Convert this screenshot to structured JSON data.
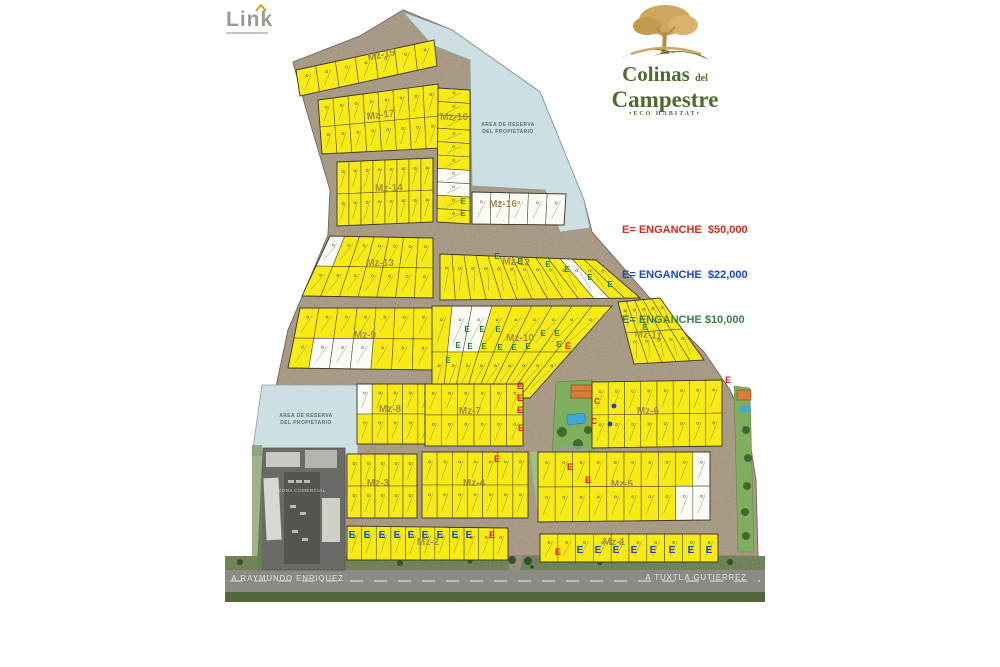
{
  "branding": {
    "link_logo": {
      "text": "Link"
    },
    "project_logo": {
      "line1": "Colinas",
      "line1_suffix": "del",
      "line2": "Campestre",
      "tagline": "•ECO HABITAT•"
    }
  },
  "legend": {
    "items": [
      {
        "label": "E= ENGANCHE  $50,000",
        "color": "#d42a1c"
      },
      {
        "label": "E= ENGANCHE  $22,000",
        "color": "#1c45c8"
      },
      {
        "label": "E= ENGANCHE $10,000",
        "color": "#3d7a4a"
      }
    ]
  },
  "roads": {
    "left_label": "A RAYMUNDO ENRIQUEZ",
    "right_label": "A TUXTLA GUTIERREZ"
  },
  "map": {
    "reserve_label": [
      "AREA DE RESERVA",
      "DEL PROPIETARIO"
    ],
    "commercial_label": "ZONA COMERCIAL",
    "colors": {
      "lot_yellow": "#f7ea15",
      "lot_white": "#fcfcf6",
      "road": "#a39178",
      "reserve": "#ccdfe2",
      "grass": "#5d7340",
      "mark_green": "#1e7e1e",
      "mark_red": "#e01818",
      "mark_blue": "#1742d8"
    },
    "outline": [
      [
        403,
        10
      ],
      [
        452,
        30
      ],
      [
        540,
        92
      ],
      [
        584,
        200
      ],
      [
        592,
        232
      ],
      [
        648,
        296
      ],
      [
        704,
        352
      ],
      [
        730,
        390
      ],
      [
        748,
        430
      ],
      [
        756,
        480
      ],
      [
        758,
        556
      ],
      [
        258,
        556
      ],
      [
        262,
        470
      ],
      [
        268,
        430
      ],
      [
        277,
        382
      ],
      [
        288,
        330
      ],
      [
        305,
        290
      ],
      [
        328,
        235
      ],
      [
        330,
        190
      ],
      [
        302,
        95
      ],
      [
        293,
        62
      ],
      [
        360,
        36
      ]
    ],
    "reserves": [
      {
        "poly": [
          [
            403,
            12
          ],
          [
            452,
            30
          ],
          [
            540,
            92
          ],
          [
            584,
            200
          ],
          [
            590,
            228
          ],
          [
            560,
            232
          ],
          [
            545,
            190
          ],
          [
            472,
            186
          ],
          [
            470,
            60
          ],
          [
            432,
            45
          ]
        ],
        "label_pos": [
          508,
          126
        ]
      },
      {
        "poly": [
          [
            262,
            385
          ],
          [
            358,
            385
          ],
          [
            358,
            455
          ],
          [
            252,
            455
          ]
        ],
        "label_pos": [
          306,
          417
        ]
      }
    ],
    "medians": [
      [
        [
          604,
          310
        ],
        [
          611,
          310
        ],
        [
          521,
          395
        ],
        [
          514,
          395
        ]
      ],
      [
        [
          530,
          452
        ],
        [
          537,
          452
        ],
        [
          545,
          518
        ],
        [
          538,
          518
        ]
      ]
    ],
    "blocks": [
      {
        "name": "Mz-15",
        "poly": [
          [
            296,
            70
          ],
          [
            434,
            40
          ],
          [
            437,
            66
          ],
          [
            300,
            96
          ]
        ],
        "rows": 1,
        "cols": 7,
        "white": [],
        "label": [
          382,
          58
        ],
        "la": -12
      },
      {
        "name": "Mz-17",
        "poly": [
          [
            318,
            100
          ],
          [
            438,
            84
          ],
          [
            441,
            148
          ],
          [
            322,
            154
          ]
        ],
        "rows": 2,
        "cols": 8,
        "white": [],
        "label": [
          381,
          118
        ],
        "la": -8
      },
      {
        "name": "Mz-16",
        "poly": [
          [
            438,
            88
          ],
          [
            470,
            90
          ],
          [
            470,
            224
          ],
          [
            437,
            222
          ]
        ],
        "rows": 10,
        "cols": 1,
        "white": [
          6,
          7
        ],
        "label": [
          454,
          120
        ],
        "la": 0
      },
      {
        "name": "Mz-16",
        "poly": [
          [
            472,
            192
          ],
          [
            566,
            194
          ],
          [
            564,
            225
          ],
          [
            472,
            224
          ]
        ],
        "rows": 1,
        "cols": 5,
        "white": [
          0,
          1,
          2,
          3,
          4
        ],
        "label": [
          503,
          207
        ],
        "la": 0
      },
      {
        "name": "Mz-14",
        "poly": [
          [
            337,
            162
          ],
          [
            433,
            158
          ],
          [
            433,
            222
          ],
          [
            337,
            226
          ]
        ],
        "rows": 2,
        "cols": 8,
        "white": [],
        "label": [
          389,
          191
        ],
        "la": -2
      },
      {
        "name": "Mz-13",
        "poly": [
          [
            330,
            236
          ],
          [
            433,
            238
          ],
          [
            433,
            298
          ],
          [
            302,
            296
          ]
        ],
        "rows": 2,
        "cols": 7,
        "white": [
          0
        ],
        "label": [
          380,
          266
        ],
        "la": 0
      },
      {
        "name": "Mz-12",
        "poly": [
          [
            440,
            254
          ],
          [
            596,
            260
          ],
          [
            640,
            298
          ],
          [
            440,
            300
          ]
        ],
        "rows": 1,
        "cols": 13,
        "white": [
          10
        ],
        "label": [
          516,
          265
        ],
        "la": 3
      },
      {
        "name": "Mz-9",
        "poly": [
          [
            300,
            308
          ],
          [
            433,
            308
          ],
          [
            433,
            370
          ],
          [
            288,
            368
          ]
        ],
        "rows": 2,
        "cols": 7,
        "white": [
          8,
          9,
          10
        ],
        "label": [
          365,
          338
        ],
        "la": 0
      },
      {
        "name": "Mz-10",
        "poly": [
          [
            432,
            306
          ],
          [
            612,
            306
          ],
          [
            530,
            398
          ],
          [
            432,
            398
          ]
        ],
        "rows": 2,
        "cols": 9,
        "white": [
          1,
          2
        ],
        "label": [
          520,
          341
        ],
        "la": 0
      },
      {
        "name": "Mz-11",
        "poly": [
          [
            618,
            302
          ],
          [
            660,
            298
          ],
          [
            704,
            360
          ],
          [
            634,
            364
          ]
        ],
        "rows": 2,
        "cols": 5,
        "white": [],
        "label": [
          648,
          338
        ],
        "la": 5
      },
      {
        "name": "Mz-8",
        "poly": [
          [
            357,
            384
          ],
          [
            433,
            384
          ],
          [
            433,
            444
          ],
          [
            357,
            444
          ]
        ],
        "rows": 2,
        "cols": 5,
        "white": [
          0
        ],
        "label": [
          390,
          412
        ],
        "la": 0
      },
      {
        "name": "Mz-7",
        "poly": [
          [
            425,
            384
          ],
          [
            523,
            384
          ],
          [
            523,
            446
          ],
          [
            425,
            446
          ]
        ],
        "rows": 2,
        "cols": 6,
        "white": [],
        "label": [
          470,
          414
        ],
        "la": 0
      },
      {
        "name": "Mz-6",
        "poly": [
          [
            592,
            382
          ],
          [
            722,
            380
          ],
          [
            722,
            446
          ],
          [
            592,
            448
          ]
        ],
        "rows": 2,
        "cols": 8,
        "white": [],
        "label": [
          648,
          414
        ],
        "la": 0
      },
      {
        "name": "Mz-3",
        "poly": [
          [
            347,
            454
          ],
          [
            417,
            454
          ],
          [
            417,
            518
          ],
          [
            347,
            518
          ]
        ],
        "rows": 2,
        "cols": 5,
        "white": [],
        "label": [
          378,
          486
        ],
        "la": 0
      },
      {
        "name": "Mz-4",
        "poly": [
          [
            422,
            452
          ],
          [
            528,
            452
          ],
          [
            528,
            518
          ],
          [
            422,
            518
          ]
        ],
        "rows": 2,
        "cols": 7,
        "white": [],
        "label": [
          474,
          486
        ],
        "la": 0
      },
      {
        "name": "Mz-5",
        "poly": [
          [
            538,
            452
          ],
          [
            710,
            452
          ],
          [
            710,
            520
          ],
          [
            538,
            522
          ]
        ],
        "rows": 2,
        "cols": 10,
        "white": [
          9,
          18,
          19
        ],
        "label": [
          622,
          487
        ],
        "la": 0
      },
      {
        "name": "Mz-2",
        "poly": [
          [
            347,
            526
          ],
          [
            508,
            528
          ],
          [
            508,
            560
          ],
          [
            347,
            560
          ]
        ],
        "rows": 1,
        "cols": 11,
        "white": [],
        "label": [
          428,
          545
        ],
        "la": 0
      },
      {
        "name": "Mz-1",
        "poly": [
          [
            540,
            534
          ],
          [
            718,
            534
          ],
          [
            718,
            562
          ],
          [
            540,
            562
          ]
        ],
        "rows": 1,
        "cols": 10,
        "white": [],
        "label": [
          614,
          545
        ],
        "la": 1
      }
    ],
    "marks": {
      "E_green": [
        [
          463,
          204
        ],
        [
          463,
          216
        ],
        [
          497,
          259
        ],
        [
          520,
          264
        ],
        [
          548,
          267
        ],
        [
          567,
          272
        ],
        [
          590,
          280
        ],
        [
          610,
          287
        ],
        [
          467,
          332
        ],
        [
          482,
          332
        ],
        [
          498,
          332
        ],
        [
          543,
          336
        ],
        [
          557,
          336
        ],
        [
          458,
          348
        ],
        [
          470,
          349
        ],
        [
          484,
          349
        ],
        [
          500,
          350
        ],
        [
          514,
          350
        ],
        [
          528,
          349
        ],
        [
          559,
          347
        ],
        [
          448,
          363
        ],
        [
          645,
          330
        ]
      ],
      "E_red": [
        [
          568,
          349
        ],
        [
          520,
          389
        ],
        [
          520,
          401
        ],
        [
          520,
          413
        ],
        [
          521,
          431
        ],
        [
          728,
          383
        ],
        [
          497,
          462
        ],
        [
          570,
          470
        ],
        [
          588,
          483
        ],
        [
          492,
          538
        ],
        [
          558,
          555
        ]
      ],
      "E_blue": [
        [
          352,
          538
        ],
        [
          367,
          538
        ],
        [
          382,
          538
        ],
        [
          397,
          538
        ],
        [
          411,
          538
        ],
        [
          425,
          538
        ],
        [
          440,
          538
        ],
        [
          455,
          538
        ],
        [
          469,
          538
        ],
        [
          580,
          553
        ],
        [
          598,
          553
        ],
        [
          616,
          553
        ],
        [
          634,
          553
        ],
        [
          653,
          553
        ],
        [
          672,
          553
        ],
        [
          691,
          553
        ],
        [
          709,
          553
        ]
      ],
      "C_red": [
        [
          597,
          404
        ],
        [
          594,
          424
        ]
      ],
      "dots_blue": [
        [
          614,
          406
        ],
        [
          610,
          424
        ]
      ]
    }
  }
}
